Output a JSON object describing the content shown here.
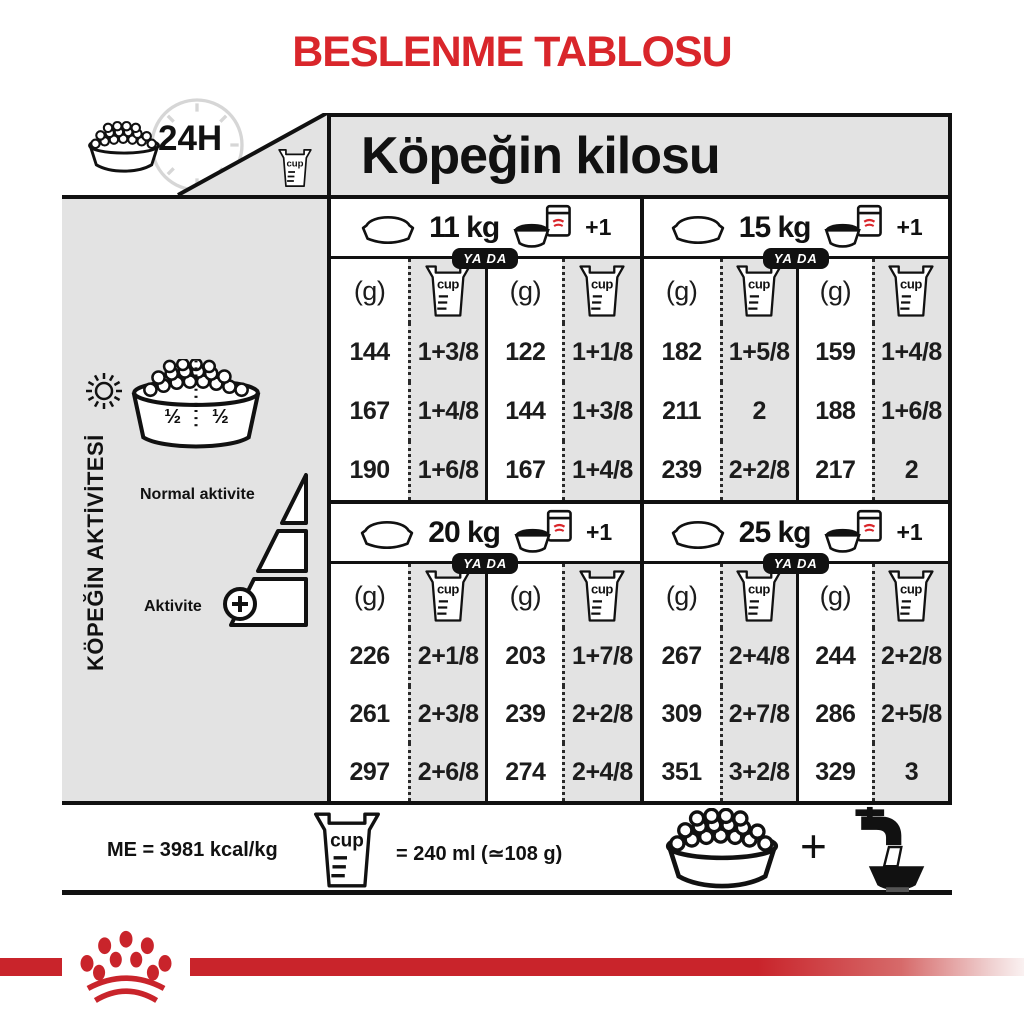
{
  "title": "BESLENME TABLOSU",
  "colors": {
    "accent_red": "#d9262b",
    "table_gray": "#e3e3e3",
    "logo_red": "#c9242b"
  },
  "table": {
    "corner_badge": "24H",
    "cup_label": "cup",
    "weight_header": "Köpeğin kilosu",
    "or_label": "YA DA",
    "plus_one": "+1",
    "gram_unit": "(g)",
    "sections": [
      {
        "weight": "11 kg",
        "rows": [
          [
            "144",
            "1+3/8",
            "122",
            "1+1/8"
          ],
          [
            "167",
            "1+4/8",
            "144",
            "1+3/8"
          ],
          [
            "190",
            "1+6/8",
            "167",
            "1+4/8"
          ]
        ]
      },
      {
        "weight": "15 kg",
        "rows": [
          [
            "182",
            "1+5/8",
            "159",
            "1+4/8"
          ],
          [
            "211",
            "2",
            "188",
            "1+6/8"
          ],
          [
            "239",
            "2+2/8",
            "217",
            "2"
          ]
        ]
      },
      {
        "weight": "20 kg",
        "rows": [
          [
            "226",
            "2+1/8",
            "203",
            "1+7/8"
          ],
          [
            "261",
            "2+3/8",
            "239",
            "2+2/8"
          ],
          [
            "297",
            "2+6/8",
            "274",
            "2+4/8"
          ]
        ]
      },
      {
        "weight": "25 kg",
        "rows": [
          [
            "267",
            "2+4/8",
            "244",
            "2+2/8"
          ],
          [
            "309",
            "2+7/8",
            "286",
            "2+5/8"
          ],
          [
            "351",
            "3+2/8",
            "329",
            "3"
          ]
        ]
      }
    ]
  },
  "sidebar": {
    "title": "KÖPEĞİN AKTİVİTESİ",
    "half_left": "½",
    "half_right": "½",
    "normal_label": "Normal aktivite",
    "active_label": "Aktivite"
  },
  "footer": {
    "me_text": "ME = 3981 kcal/kg",
    "cup_equiv": "= 240 ml (≃108 g)",
    "plus": "+"
  }
}
